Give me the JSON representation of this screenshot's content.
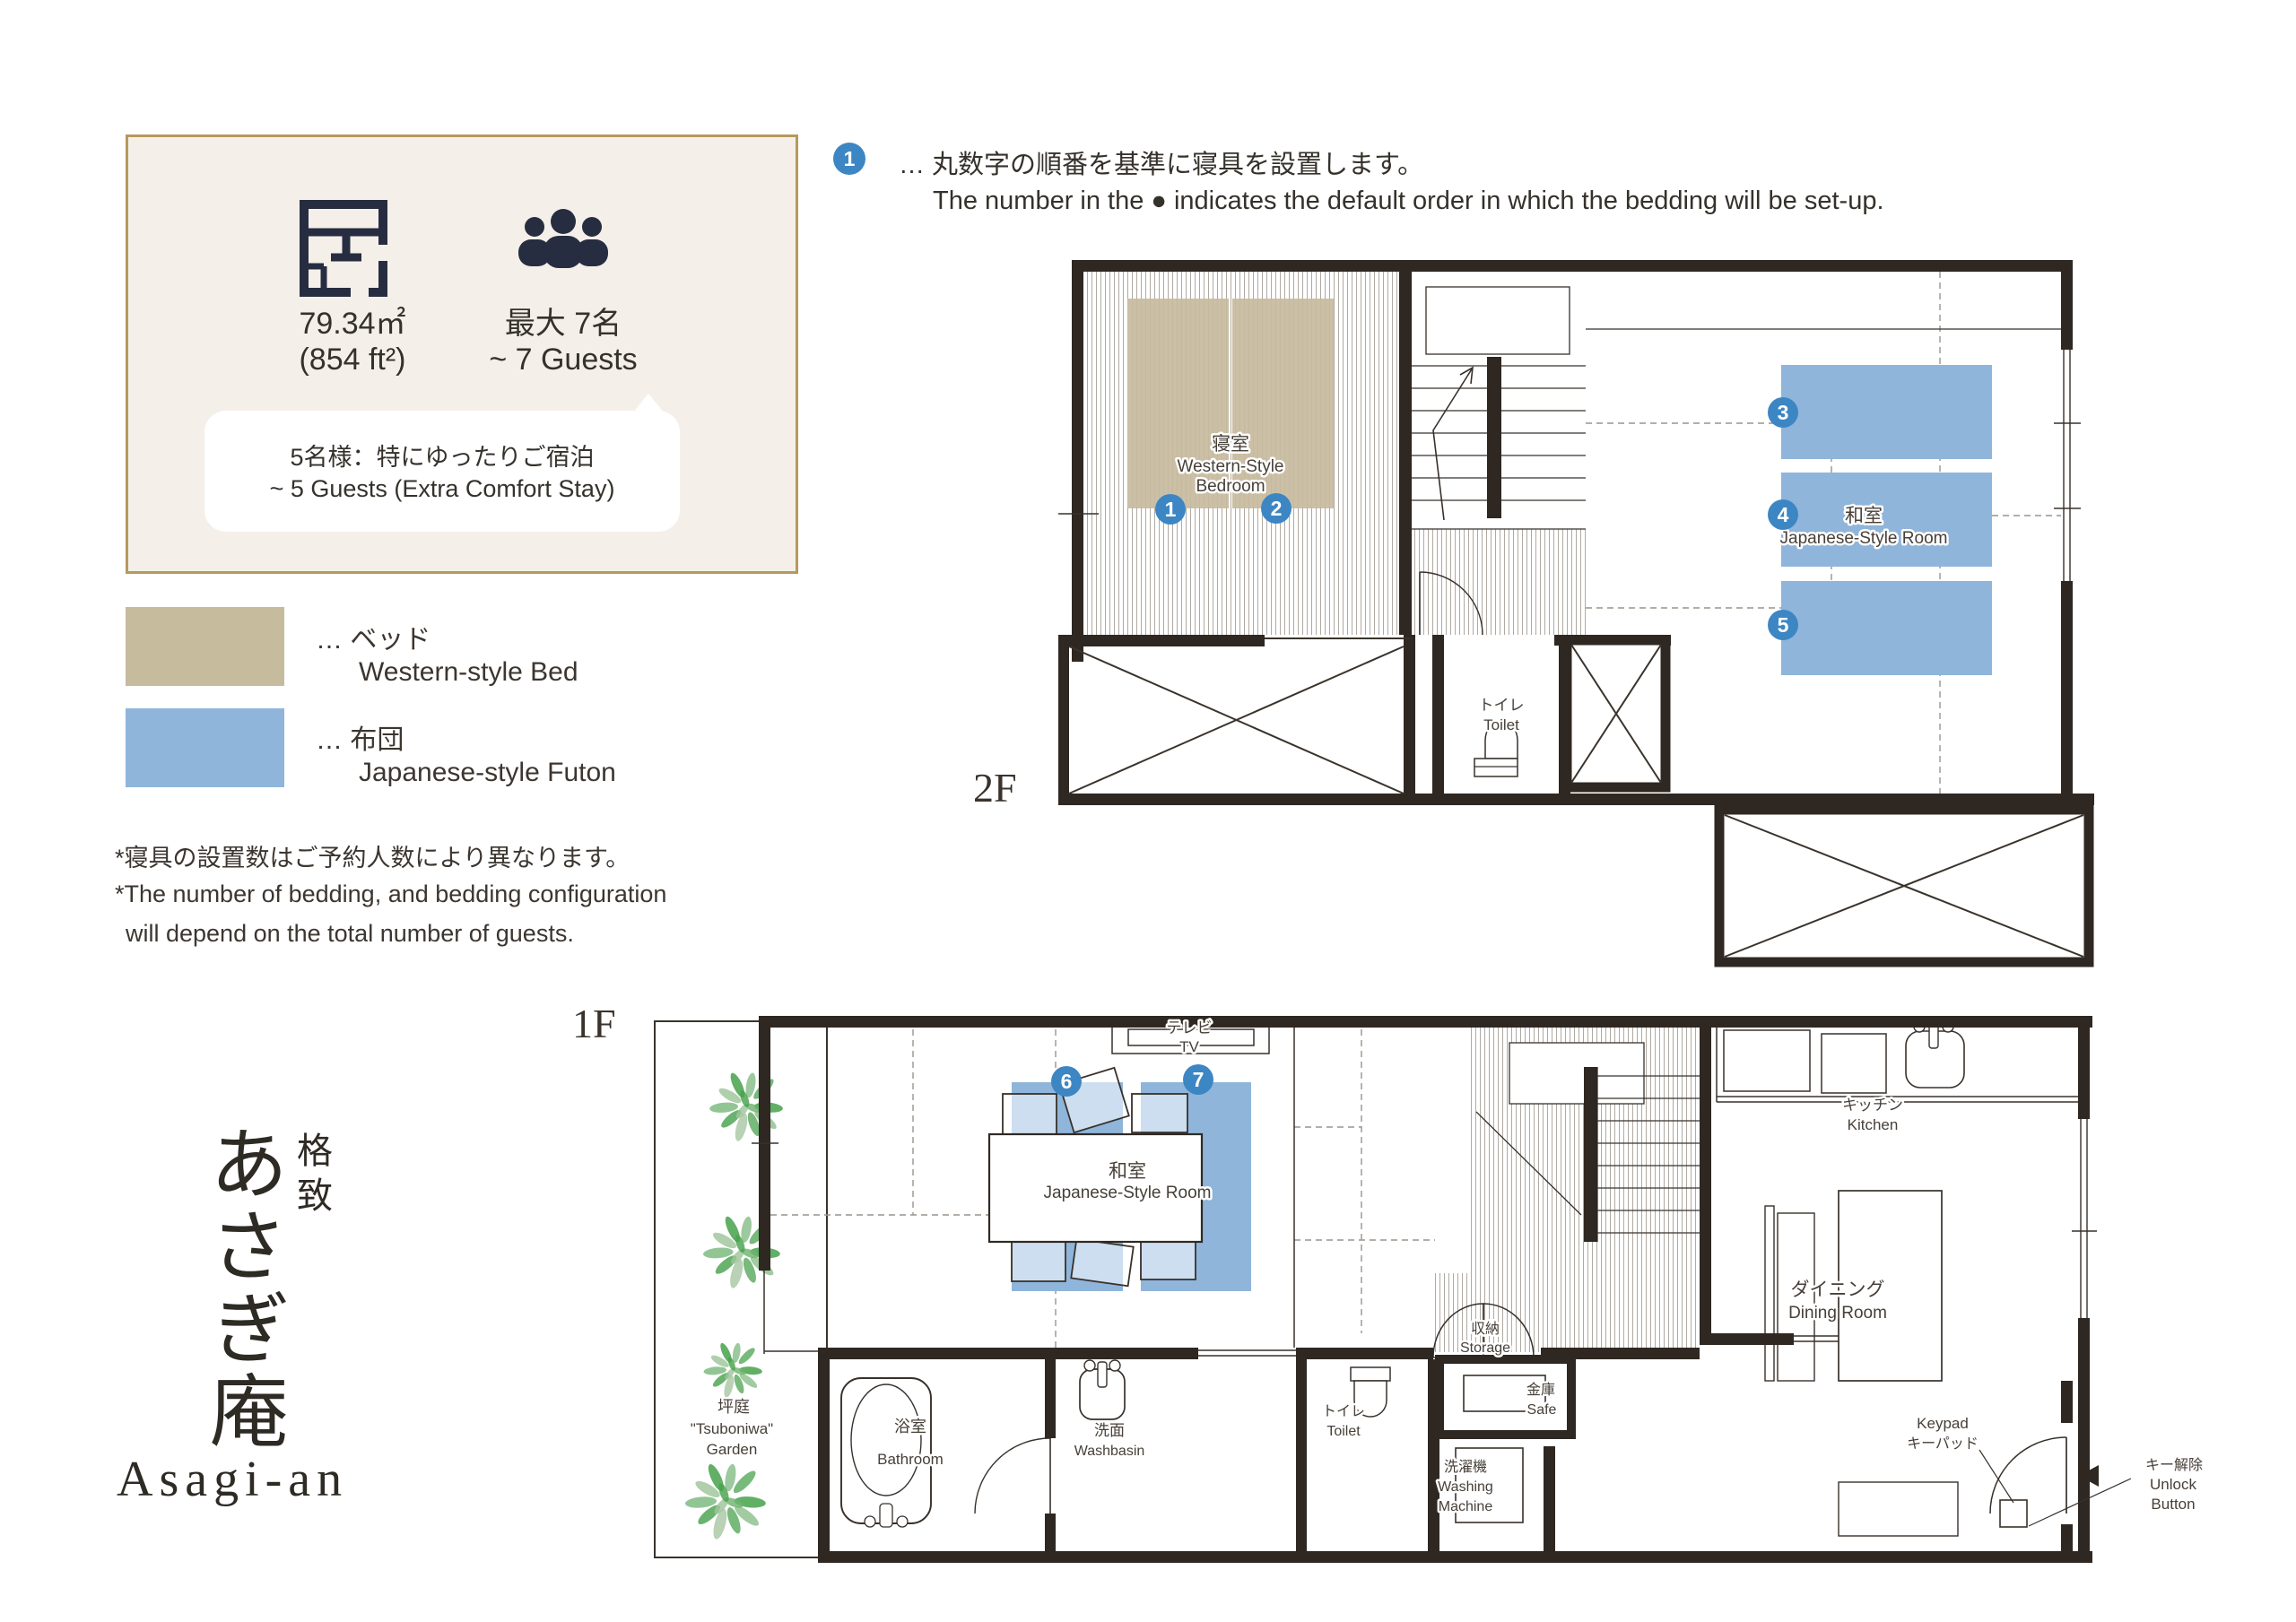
{
  "info_box": {
    "area_line1": "79.34㎡",
    "area_line2": "(854 ft²)",
    "guests_line1": "最大 7名",
    "guests_line2": "~ 7 Guests",
    "bubble_line1": "5名様：特にゆったりご宿泊",
    "bubble_line2": "~ 5 Guests (Extra Comfort Stay)"
  },
  "legend": {
    "bed_ja": "… ベッド",
    "bed_en": "Western-style Bed",
    "futon_ja": "… 布団",
    "futon_en": "Japanese-style Futon"
  },
  "footnote": {
    "ja": "*寝具の設置数はご予約人数により異なります。",
    "en_line1": "*The number of bedding, and bedding configuration",
    "en_line2": "will depend on the total number of guests."
  },
  "bedding_note": {
    "number": "1",
    "ja": "… 丸数字の順番を基準に寝具を設置します。",
    "en": "The number in the ● indicates the default order in which the bedding will be set-up."
  },
  "floor2": {
    "label": "2F",
    "bedroom_ja": "寝室",
    "bedroom_en1": "Western-Style",
    "bedroom_en2": "Bedroom",
    "bed_numbers": [
      "1",
      "2"
    ],
    "jroom_ja": "和室",
    "jroom_en": "Japanese-Style Room",
    "futon_numbers": [
      "3",
      "4",
      "5"
    ],
    "toilet_ja": "トイレ",
    "toilet_en": "Toilet"
  },
  "floor1": {
    "label": "1F",
    "tv_ja": "テレビ",
    "tv_en": "TV",
    "jroom_ja": "和室",
    "jroom_en": "Japanese-Style Room",
    "futon_numbers": [
      "6",
      "7"
    ],
    "garden_ja": "坪庭",
    "garden_en1": "\"Tsuboniwa\"",
    "garden_en2": "Garden",
    "bathroom_ja": "浴室",
    "bathroom_en": "Bathroom",
    "washbasin_ja": "洗面",
    "washbasin_en": "Washbasin",
    "toilet_ja": "トイレ",
    "toilet_en": "Toilet",
    "washer_ja": "洗濯機",
    "washer_en1": "Washing",
    "washer_en2": "Machine",
    "storage_ja": "収納",
    "storage_en": "Storage",
    "safe_ja": "金庫",
    "safe_en": "Safe",
    "kitchen_ja": "キッチン",
    "kitchen_en": "Kitchen",
    "dining_ja": "ダイニング",
    "dining_en": "Dining Room",
    "keypad_en": "Keypad",
    "keypad_ja": "キーパッド",
    "unlock_ja": "キー解除",
    "unlock_en1": "Unlock",
    "unlock_en2": "Button"
  },
  "title": {
    "prefix": "格致",
    "name_ja": "あさぎ庵",
    "name_en": "Asagi-an"
  },
  "colors": {
    "bed": "#c7bb9e",
    "futon": "#8fb5db",
    "number_circle": "#3d86c4",
    "wall": "#2f2721",
    "accent_border": "#b6995c"
  }
}
